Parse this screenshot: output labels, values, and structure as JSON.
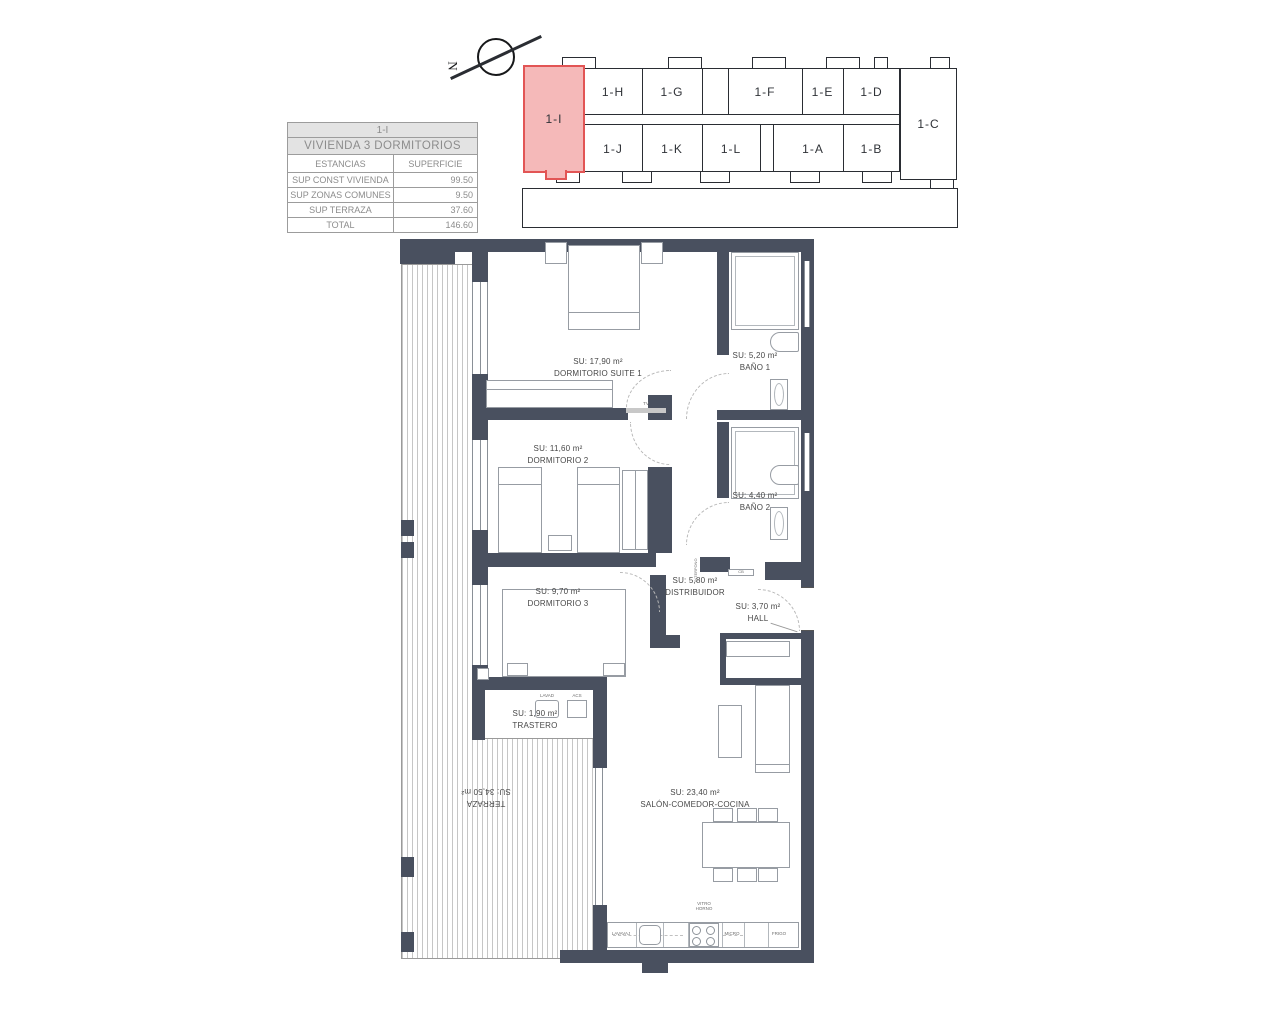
{
  "colors": {
    "wall": "#49505f",
    "highlight_fill": "#f5b9b9",
    "highlight_stroke": "#e25555",
    "outline": "#2a2d33"
  },
  "compass": {
    "north_label": "N"
  },
  "keyplan": {
    "highlighted": "1-I",
    "right": "1-C",
    "top_row": [
      "1-H",
      "1-G",
      "1-F",
      "1-E",
      "1-D"
    ],
    "bottom_row": [
      "1-J",
      "1-K",
      "1-L",
      "1-A",
      "1-B"
    ]
  },
  "info_table": {
    "unit_code": "1-I",
    "type_title": "VIVIENDA 3 DORMITORIOS",
    "col_estancias": "ESTANCIAS",
    "col_superficie": "SUPERFICIE",
    "rows": [
      {
        "label": "SUP CONST VIVIENDA",
        "value": "99.50"
      },
      {
        "label": "SUP ZONAS COMUNES",
        "value": "9.50"
      },
      {
        "label": "SUP TERRAZA",
        "value": "37.60"
      },
      {
        "label": "TOTAL",
        "value": "146.60"
      }
    ]
  },
  "floorplan": {
    "rooms": {
      "suite1": {
        "area": "SU: 17,90 m²",
        "name": "DORMITORIO SUITE 1"
      },
      "bano1": {
        "area": "SU: 5,20 m²",
        "name": "BAÑO 1"
      },
      "dorm2": {
        "area": "SU: 11,60 m²",
        "name": "DORMITORIO 2"
      },
      "bano2": {
        "area": "SU: 4,40 m²",
        "name": "BAÑO 2"
      },
      "distribuidor": {
        "area": "SU: 5,80 m²",
        "name": "DISTRIBUIDOR"
      },
      "hall": {
        "area": "SU: 3,70 m²",
        "name": "HALL"
      },
      "dorm3": {
        "area": "SU: 9,70 m²",
        "name": "DORMITORIO 3"
      },
      "trastero": {
        "area": "SU: 1,90 m²",
        "name": "TRASTERO"
      },
      "terraza": {
        "name": "TERRAZA",
        "area": "SU: 34,50 m²"
      },
      "salon": {
        "area": "SU: 23,40 m²",
        "name": "SALÓN-COMEDOR-COCINA"
      }
    },
    "fixtures": {
      "tv": "TV",
      "lavadora": "LAVAD",
      "acs": "ACS",
      "interfono": "INTERFONO",
      "cb": "CB",
      "lavavajillas": "LAVAVAJ",
      "vitro_line1": "VITRO",
      "vitro_line2": "HORNO",
      "micro": "MICRO",
      "frigo": "FRIGO"
    }
  }
}
